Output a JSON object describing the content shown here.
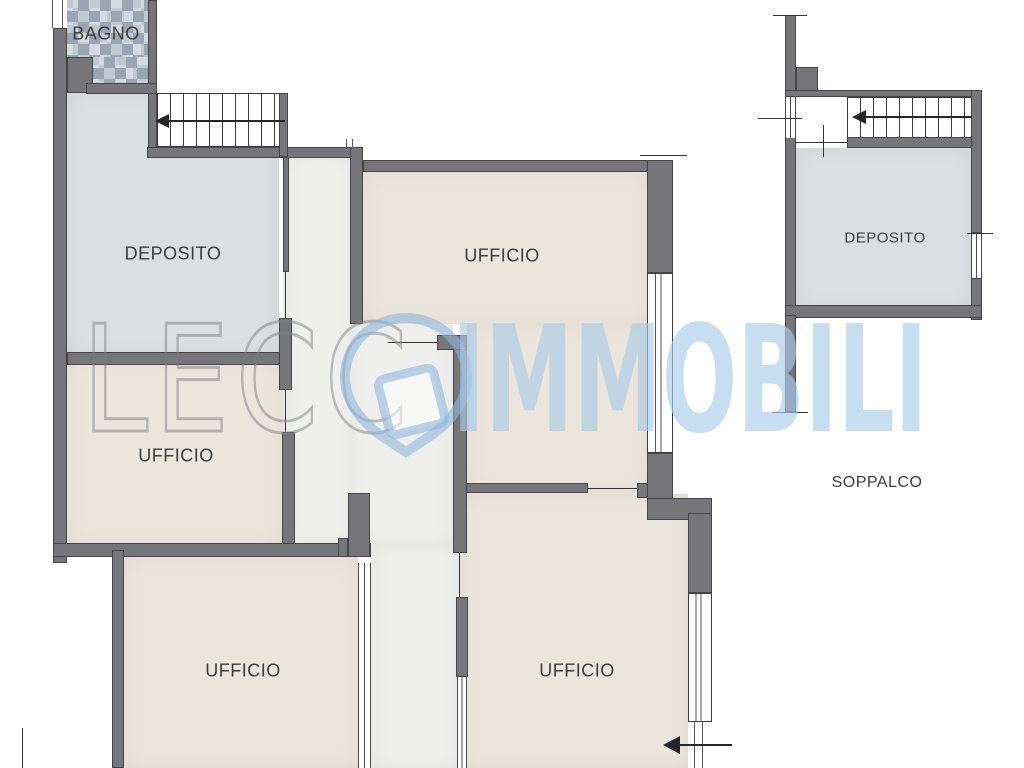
{
  "rooms": {
    "bagno": {
      "label": "BAGNO"
    },
    "deposito_left": {
      "label": "DEPOSITO"
    },
    "ufficio_top": {
      "label": "UFFICIO"
    },
    "ufficio_mid_left": {
      "label": "UFFICIO"
    },
    "ufficio_bottom_left": {
      "label": "UFFICIO"
    },
    "ufficio_bottom_right": {
      "label": "UFFICIO"
    },
    "deposito_right": {
      "label": "DEPOSITO"
    },
    "soppalco": {
      "label": "SOPPALCO"
    }
  },
  "watermark": {
    "text_left": "LECC",
    "text_right": "IMMOBILI",
    "logo": "map-pin-with-tilted-box"
  },
  "colors": {
    "wall": "#76767a",
    "wall_outline": "#46464a",
    "floor_deposito": "#dddee1",
    "floor_ufficio": "#ebe5dc",
    "floor_corridor": "#eff0ee",
    "tile_light": "#c0c8d1",
    "tile_dark": "#9aa5b3",
    "label": "#3c3c3c",
    "line": "#353538",
    "wm_outline": "#7d808580",
    "wm_fill": "#a9cbe8a6",
    "wm_logo": "#8fb6dc99"
  }
}
